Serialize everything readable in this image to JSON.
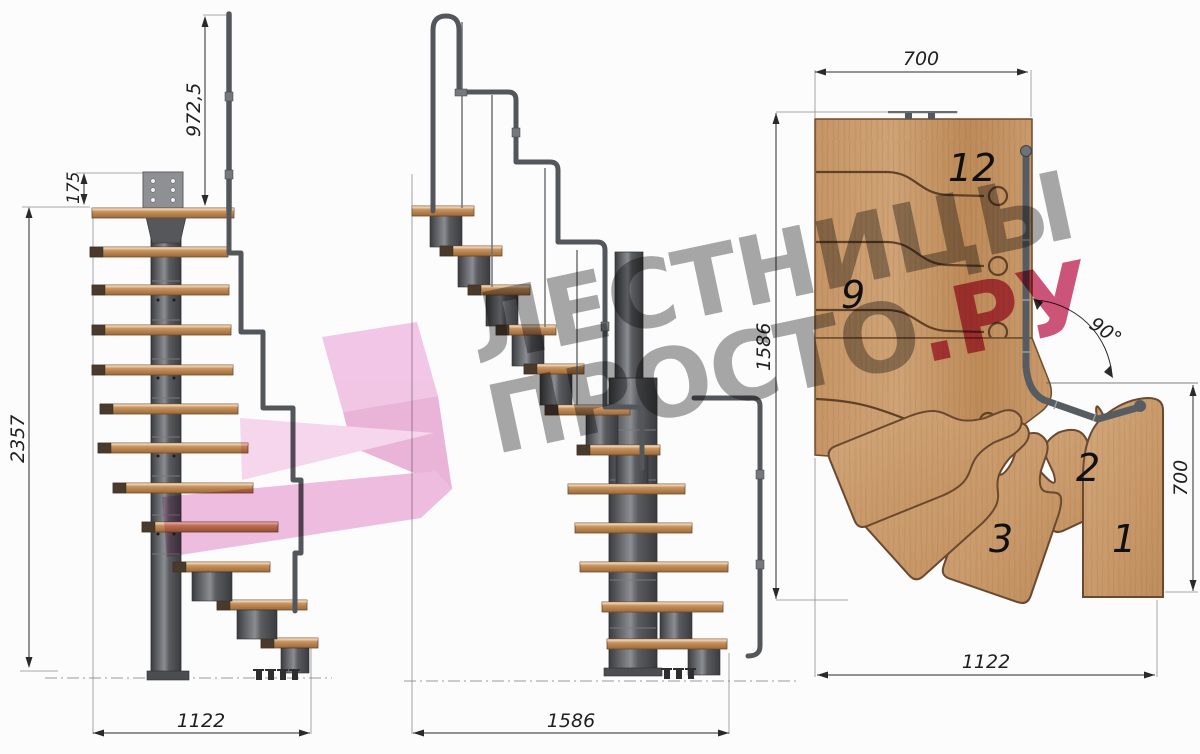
{
  "views": {
    "front": {
      "dim_handrail_height": "972,5",
      "dim_top_offset": "175",
      "dim_total_height": "2357",
      "dim_width": "1122"
    },
    "side": {
      "dim_length": "1586"
    },
    "plan": {
      "dim_top_width": "700",
      "dim_side_length": "1586",
      "dim_right_width": "700",
      "dim_bottom_width": "1122",
      "dim_turn_angle": "90°",
      "step_numbers": {
        "n12": "12",
        "n9": "9",
        "n3": "3",
        "n2": "2",
        "n1": "1"
      }
    }
  },
  "watermark": {
    "line1": "ЛЕСТНИЦЫ",
    "line2": "ПРОСТО",
    "suffix": ".РУ"
  },
  "colors": {
    "wood": "#c79b6f",
    "wood_dark": "#a97849",
    "metal": "#55585c",
    "groove": "#5f4127",
    "dimension": "#2a2a2a",
    "watermark_gray": "#919191",
    "watermark_accent": "#c63f64",
    "arrow_pink": "#efb3dc"
  }
}
